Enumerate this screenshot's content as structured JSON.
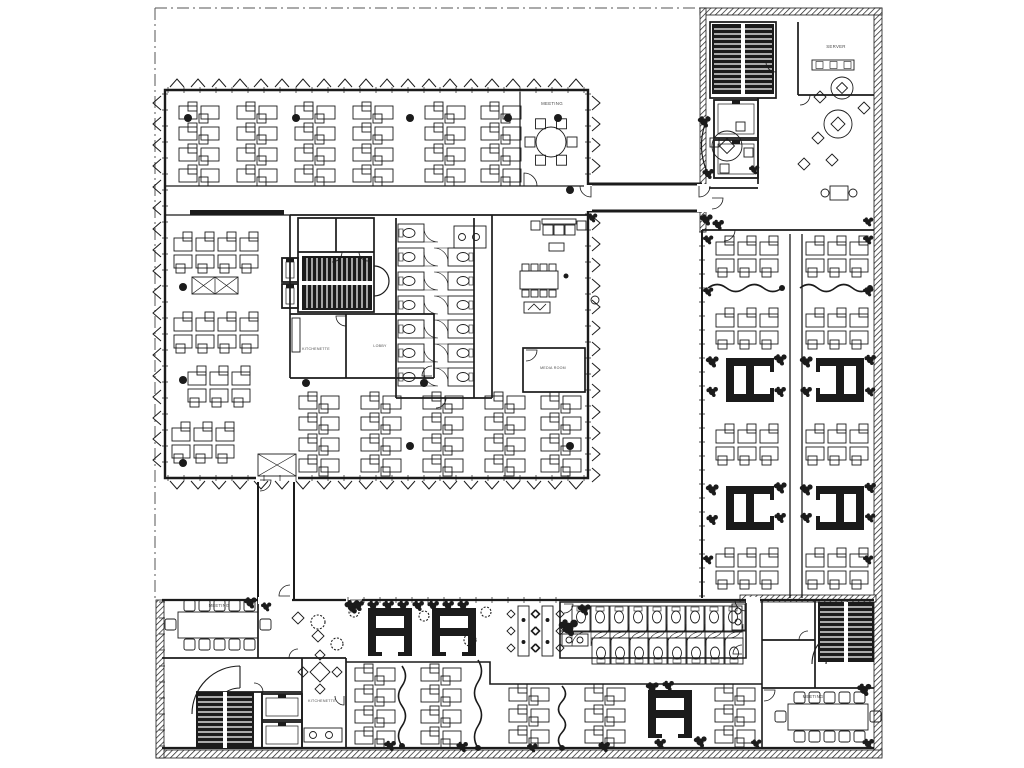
{
  "meta": {
    "title": "Office building floor plan",
    "ink": "#1b1b1b",
    "paper": "#ffffff",
    "label_color": "#4a4a4a"
  },
  "labels": [
    {
      "id": "meeting-nw",
      "text": "MEETING",
      "x": 552,
      "y": 105,
      "size": 4.4
    },
    {
      "id": "server",
      "text": "SERVER",
      "x": 836,
      "y": 48,
      "size": 4.4
    },
    {
      "id": "kitchenette-core",
      "text": "KITCHENETTE",
      "x": 316,
      "y": 350,
      "size": 3.6
    },
    {
      "id": "lobby",
      "text": "LOBBY",
      "x": 380,
      "y": 347,
      "size": 3.6
    },
    {
      "id": "media-room",
      "text": "MEDIA ROOM",
      "x": 553,
      "y": 369,
      "size": 3.6
    },
    {
      "id": "meeting-sw",
      "text": "MEETING",
      "x": 219,
      "y": 607,
      "size": 4.2
    },
    {
      "id": "kitchenette-sw",
      "text": "KITCHENETTE",
      "x": 322,
      "y": 702,
      "size": 3.6
    },
    {
      "id": "meeting-se",
      "text": "MEETING",
      "x": 813,
      "y": 698,
      "size": 4.2
    }
  ],
  "furniture": {
    "cluster_v4": [
      [
        178,
        102
      ],
      [
        236,
        102
      ],
      [
        294,
        102
      ],
      [
        352,
        102
      ],
      [
        424,
        102
      ],
      [
        480,
        102
      ],
      [
        298,
        392
      ],
      [
        360,
        392
      ],
      [
        422,
        392
      ],
      [
        484,
        392
      ],
      [
        540,
        392
      ],
      [
        354,
        664
      ],
      [
        420,
        664
      ]
    ],
    "cluster_v3": [
      [
        508,
        684
      ],
      [
        584,
        684
      ],
      [
        714,
        684
      ]
    ],
    "cluster_h4": [
      [
        172,
        232
      ],
      [
        172,
        312
      ]
    ],
    "cluster_h3": [
      [
        186,
        366
      ],
      [
        170,
        422
      ],
      [
        714,
        236
      ],
      [
        714,
        308
      ],
      [
        714,
        424
      ],
      [
        714,
        548
      ],
      [
        804,
        236
      ],
      [
        804,
        308
      ],
      [
        804,
        424
      ],
      [
        804,
        548
      ]
    ],
    "booths": [
      [
        726,
        358,
        0
      ],
      [
        864,
        402,
        180
      ],
      [
        726,
        486,
        0
      ],
      [
        864,
        530,
        180
      ],
      [
        412,
        608,
        90
      ],
      [
        476,
        608,
        90
      ],
      [
        692,
        690,
        90
      ]
    ],
    "table12": [
      [
        178,
        612
      ],
      [
        788,
        704
      ]
    ],
    "round6": [
      [
        551,
        142
      ]
    ],
    "sq4": [
      [
        320,
        672
      ]
    ],
    "hightables": [
      [
        518,
        606
      ],
      [
        542,
        606
      ]
    ],
    "stall_runs": [
      {
        "x": 398,
        "y": 242,
        "count": 7,
        "step": 24,
        "axis": "y",
        "rot": -90
      },
      {
        "x": 474,
        "y": 248,
        "count": 6,
        "step": 24,
        "axis": "y",
        "rot": 90
      },
      {
        "x": 572,
        "y": 606,
        "count": 9,
        "step": 19,
        "axis": "x",
        "rot": 0
      },
      {
        "x": 610,
        "y": 664,
        "count": 8,
        "step": 19,
        "axis": "x",
        "rot": 180
      }
    ],
    "stairs": [
      {
        "x": 712,
        "y": 24,
        "w": 62,
        "h": 70,
        "t": "h"
      },
      {
        "x": 302,
        "y": 256,
        "w": 70,
        "h": 54,
        "t": "v"
      },
      {
        "x": 196,
        "y": 692,
        "w": 58,
        "h": 56,
        "t": "h"
      },
      {
        "x": 818,
        "y": 602,
        "w": 56,
        "h": 60,
        "t": "h"
      }
    ],
    "lifts": [
      [
        714,
        100,
        44,
        38
      ],
      [
        714,
        140,
        44,
        38
      ],
      [
        262,
        694,
        40,
        26
      ],
      [
        262,
        722,
        40,
        26
      ],
      [
        282,
        258,
        16,
        24
      ],
      [
        282,
        284,
        16,
        24
      ]
    ],
    "waves": [
      {
        "x": 402,
        "y": 666,
        "len": 80,
        "rot": 0
      },
      {
        "x": 478,
        "y": 660,
        "len": 88,
        "rot": 0
      },
      {
        "x": 562,
        "y": 686,
        "len": 62,
        "rot": 0
      },
      {
        "x": 708,
        "y": 288,
        "len": 74,
        "rot": -90
      },
      {
        "x": 800,
        "y": 288,
        "len": 70,
        "rot": -90
      }
    ],
    "plants": [
      [
        708,
        240,
        0.8
      ],
      [
        708,
        292,
        0.8
      ],
      [
        708,
        560,
        0.8
      ],
      [
        868,
        240,
        0.8
      ],
      [
        868,
        292,
        0.8
      ],
      [
        868,
        560,
        0.8
      ],
      [
        712,
        362,
        1
      ],
      [
        712,
        392,
        0.9
      ],
      [
        780,
        360,
        1
      ],
      [
        780,
        392,
        0.9
      ],
      [
        712,
        490,
        1
      ],
      [
        712,
        520,
        0.9
      ],
      [
        780,
        488,
        1
      ],
      [
        780,
        518,
        0.9
      ],
      [
        806,
        362,
        1
      ],
      [
        806,
        392,
        0.9
      ],
      [
        870,
        360,
        0.9
      ],
      [
        870,
        392,
        0.8
      ],
      [
        806,
        490,
        1
      ],
      [
        806,
        518,
        0.9
      ],
      [
        870,
        488,
        0.9
      ],
      [
        870,
        518,
        0.8
      ],
      [
        568,
        628,
        1.5
      ],
      [
        584,
        610,
        1
      ],
      [
        352,
        607,
        1.2
      ],
      [
        706,
        220,
        1
      ],
      [
        718,
        225,
        0.9
      ],
      [
        592,
        218,
        0.8
      ],
      [
        704,
        122,
        1
      ],
      [
        708,
        174,
        0.9
      ],
      [
        754,
        170,
        0.8
      ],
      [
        868,
        222,
        0.8
      ],
      [
        390,
        746,
        0.9
      ],
      [
        462,
        747,
        0.9
      ],
      [
        532,
        748,
        0.8
      ],
      [
        604,
        747,
        0.9
      ],
      [
        652,
        688,
        1
      ],
      [
        668,
        686,
        0.9
      ],
      [
        700,
        742,
        1
      ],
      [
        660,
        744,
        0.9
      ],
      [
        864,
        690,
        1.1
      ],
      [
        868,
        744,
        0.9
      ],
      [
        756,
        744,
        0.8
      ],
      [
        250,
        603,
        1
      ],
      [
        266,
        607,
        0.8
      ]
    ],
    "plant_rows": [
      {
        "x": 358,
        "y": 606,
        "count": 8,
        "step": 15,
        "s": 0.9
      }
    ],
    "poufs": [
      [
        318,
        622,
        7
      ],
      [
        337,
        644,
        6
      ],
      [
        354,
        612,
        5
      ],
      [
        424,
        616,
        5
      ],
      [
        470,
        640,
        6
      ],
      [
        486,
        612,
        5
      ]
    ],
    "dots": [
      [
        188,
        118
      ],
      [
        296,
        118
      ],
      [
        410,
        118
      ],
      [
        508,
        118
      ],
      [
        558,
        118
      ],
      [
        183,
        287
      ],
      [
        183,
        380
      ],
      [
        183,
        463
      ],
      [
        306,
        383
      ],
      [
        424,
        383
      ],
      [
        410,
        446
      ],
      [
        570,
        190
      ],
      [
        570,
        446
      ]
    ],
    "cafe": {
      "counters": [
        [
          812,
          60
        ]
      ],
      "rounds": [
        [
          842,
          88,
          11
        ],
        [
          838,
          124,
          14
        ],
        [
          727,
          146,
          15
        ]
      ],
      "diamonds": [
        [
          820,
          97
        ],
        [
          818,
          138
        ],
        [
          804,
          164
        ],
        [
          832,
          160
        ],
        [
          864,
          108
        ],
        [
          298,
          618
        ],
        [
          318,
          636
        ]
      ],
      "sq_round": [
        [
          830,
          186
        ]
      ],
      "chair_squares": [
        [
          710,
          138
        ],
        [
          736,
          122
        ],
        [
          744,
          148
        ],
        [
          720,
          164
        ]
      ]
    }
  },
  "doors": [
    [
      524,
      186,
      13,
      -90,
      0,
      1
    ],
    [
      591,
      186,
      11,
      90,
      180,
      1
    ],
    [
      699,
      186,
      11,
      90,
      0,
      0
    ],
    [
      332,
      252,
      10,
      0,
      90,
      1
    ],
    [
      368,
      252,
      9,
      180,
      90,
      0
    ],
    [
      346,
      316,
      10,
      180,
      90,
      0
    ],
    [
      432,
      376,
      10,
      180,
      270,
      1
    ],
    [
      526,
      350,
      11,
      0,
      90,
      1
    ],
    [
      436,
      398,
      10,
      0,
      90,
      1
    ],
    [
      260,
      480,
      11,
      0,
      90,
      1
    ],
    [
      290,
      596,
      11,
      180,
      270,
      1
    ],
    [
      350,
      600,
      12,
      0,
      90,
      1
    ],
    [
      746,
      600,
      11,
      180,
      90,
      0
    ],
    [
      764,
      690,
      11,
      0,
      90,
      1
    ],
    [
      800,
      95,
      10,
      0,
      90,
      1
    ],
    [
      776,
      62,
      10,
      90,
      180,
      1
    ],
    [
      712,
      198,
      11,
      0,
      90,
      1
    ],
    [
      564,
      604,
      9,
      0,
      90,
      1
    ],
    [
      742,
      654,
      9,
      180,
      270,
      1
    ],
    [
      298,
      658,
      9,
      180,
      270,
      1
    ],
    [
      344,
      696,
      9,
      90,
      180,
      1
    ],
    [
      724,
      230,
      11,
      0,
      90,
      1
    ],
    [
      808,
      640,
      9,
      180,
      270,
      1
    ],
    [
      254,
      692,
      9,
      0,
      270,
      0
    ]
  ],
  "deco": {
    "zigzag": [
      {
        "x": 170,
        "y": 87,
        "len": 416,
        "dir": "up"
      },
      {
        "x": 161,
        "y": 96,
        "len": 378,
        "dir": "left"
      },
      {
        "x": 170,
        "y": 481,
        "len": 416,
        "dir": "down"
      },
      {
        "x": 592,
        "y": 96,
        "len": 84,
        "dir": "right"
      },
      {
        "x": 592,
        "y": 216,
        "len": 258,
        "dir": "right"
      }
    ],
    "ticks": [
      {
        "x": 168,
        "y": 90,
        "len": 418,
        "axis": "h",
        "step": 16
      },
      {
        "x": 165,
        "y": 94,
        "len": 382,
        "axis": "v",
        "step": 16
      },
      {
        "x": 168,
        "y": 478,
        "len": 418,
        "axis": "h",
        "step": 16
      },
      {
        "x": 588,
        "y": 94,
        "len": 88,
        "axis": "v",
        "step": 16
      },
      {
        "x": 588,
        "y": 214,
        "len": 262,
        "axis": "v",
        "step": 16
      },
      {
        "x": 702,
        "y": 232,
        "len": 366,
        "axis": "v",
        "step": 14
      },
      {
        "x": 348,
        "y": 600,
        "len": 210,
        "axis": "h",
        "step": 16
      },
      {
        "x": 162,
        "y": 602,
        "len": 146,
        "axis": "v",
        "step": 16
      }
    ]
  }
}
